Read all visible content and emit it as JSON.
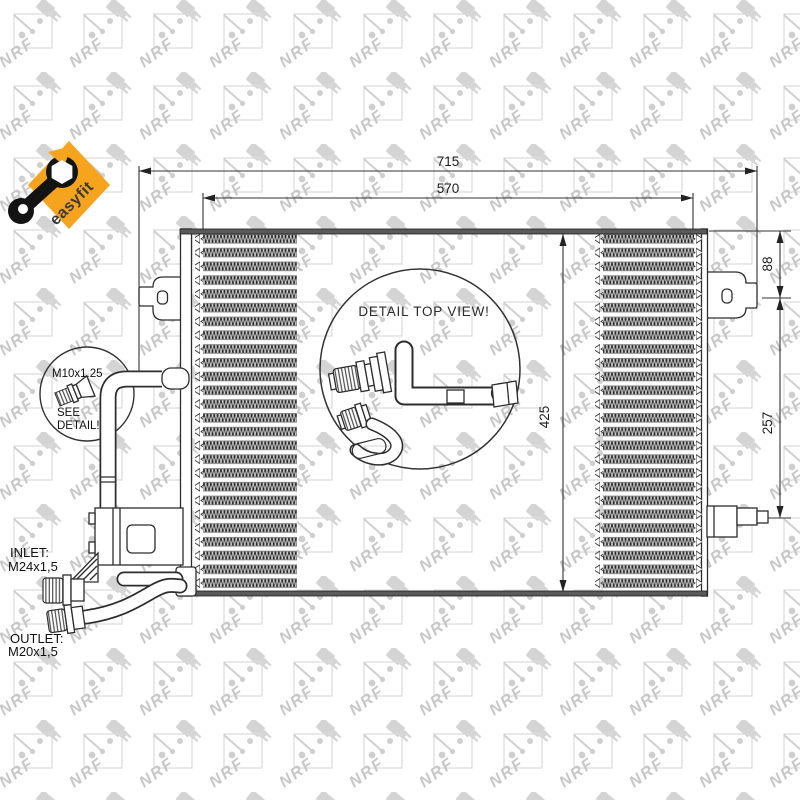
{
  "watermark": {
    "text": "NRF"
  },
  "logo": {
    "text": "easyfit"
  },
  "colors": {
    "logo_orange": "#F6A31E",
    "line": "#2d2d2d",
    "watermark_gray": "#cccccc"
  },
  "dimensions": {
    "total_width": "715",
    "core_width": "570",
    "core_height": "425",
    "bracket_offset": "88",
    "connector_offset": "257"
  },
  "detail_top_view": {
    "title": "DETAIL TOP VIEW!"
  },
  "see_detail": {
    "thread_size": "M10x1.25",
    "line1": "SEE",
    "line2": "DETAIL!"
  },
  "ports": {
    "inlet_label": "INLET:",
    "inlet_thread": "M24x1,5",
    "outlet_label": "OUTLET:",
    "outlet_thread": "M20x1,5"
  }
}
